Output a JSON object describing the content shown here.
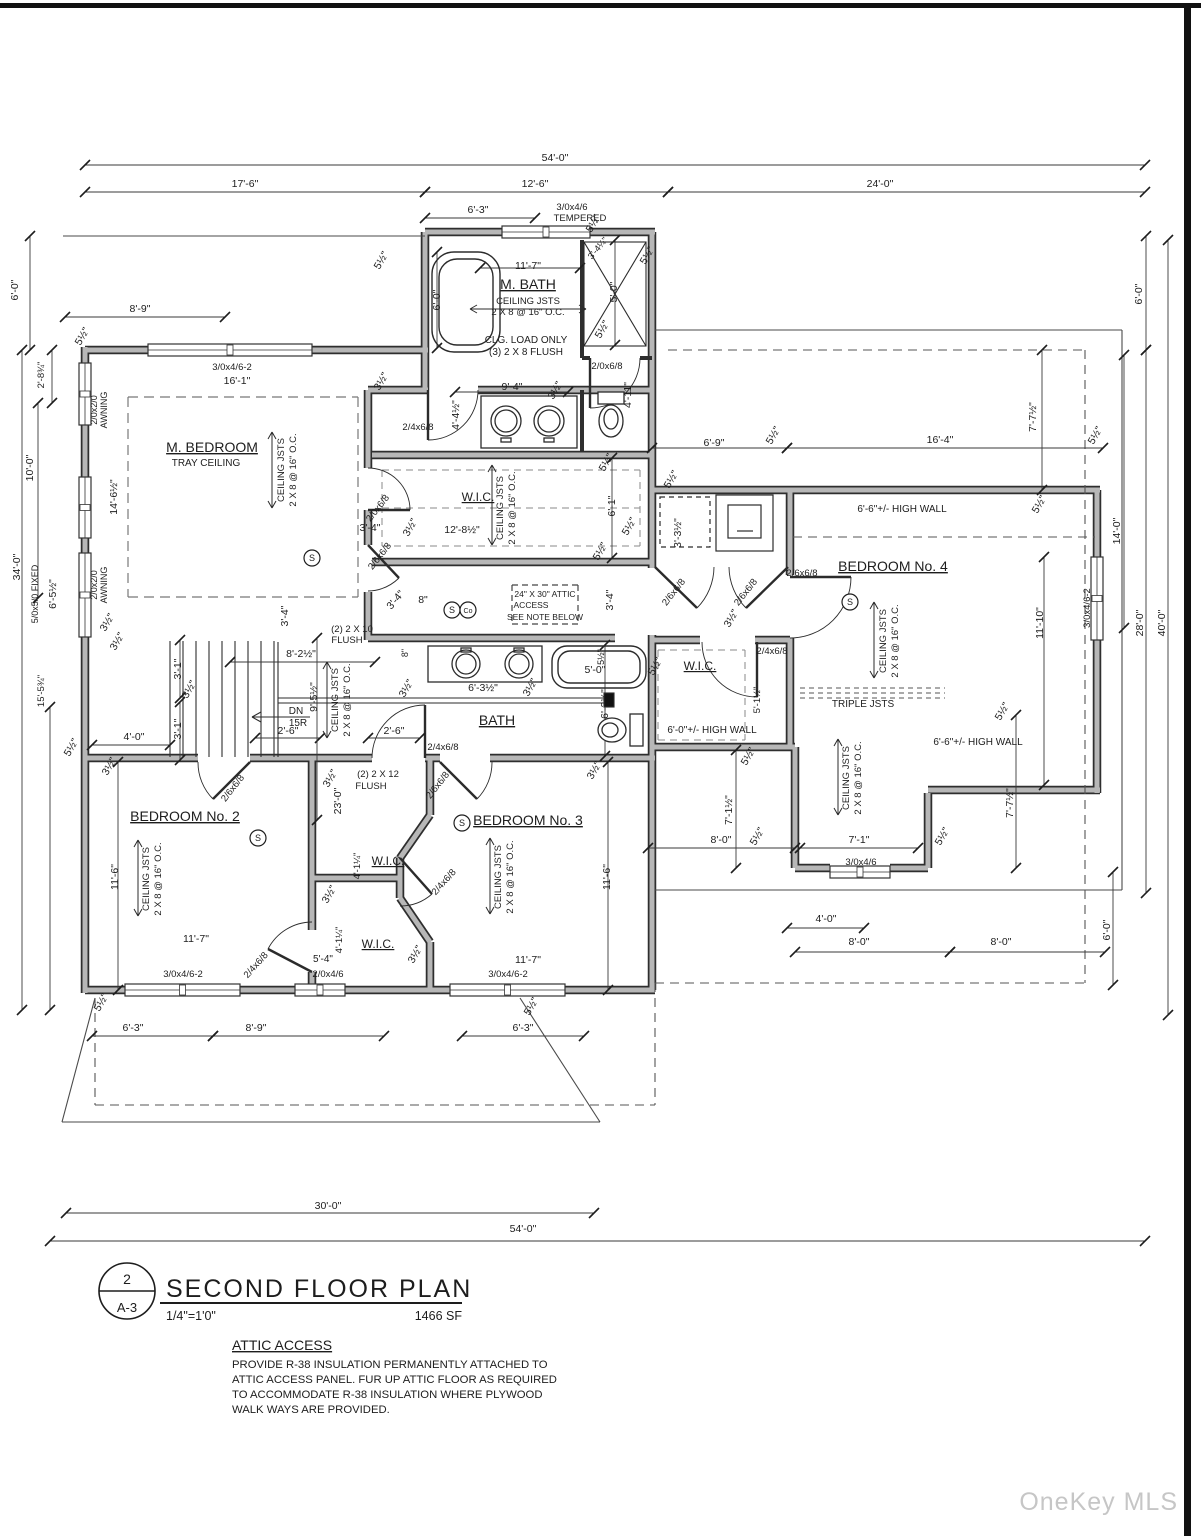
{
  "title_block": {
    "number": "2",
    "sheet": "A-3",
    "title": "SECOND FLOOR PLAN",
    "scale": "1/4\"=1'0\"",
    "area": "1466 SF"
  },
  "note": {
    "title": "ATTIC ACCESS",
    "l1": "PROVIDE R-38 INSULATION PERMANENTLY ATTACHED TO",
    "l2": "ATTIC ACCESS PANEL. FUR UP ATTIC FLOOR AS REQUIRED",
    "l3": "TO ACCOMMODATE R-38 INSULATION WHERE PLYWOOD",
    "l4": "WALK WAYS ARE PROVIDED."
  },
  "watermark": "OneKey MLS",
  "rooms": [
    "M. BEDROOM",
    "M. BATH",
    "W.I.C.",
    "BATH",
    "BEDROOM No. 2",
    "BEDROOM No. 3",
    "BEDROOM No. 4"
  ],
  "detectors": [
    {
      "x": 312,
      "y": 558,
      "t": "S"
    },
    {
      "x": 452,
      "y": 610,
      "t": "S"
    },
    {
      "x": 468,
      "y": 610,
      "t": "Co"
    },
    {
      "x": 258,
      "y": 838,
      "t": "S"
    },
    {
      "x": 462,
      "y": 823,
      "t": "S"
    },
    {
      "x": 850,
      "y": 602,
      "t": "S"
    }
  ],
  "labels": [
    {
      "t": "54'-0\"",
      "x": 555,
      "y": 161
    },
    {
      "t": "17'-6\"",
      "x": 245,
      "y": 187
    },
    {
      "t": "12'-6\"",
      "x": 535,
      "y": 187
    },
    {
      "t": "24'-0\"",
      "x": 880,
      "y": 187
    },
    {
      "t": "6'-3\"",
      "x": 478,
      "y": 213
    },
    {
      "t": "3/0x4/6",
      "x": 572,
      "y": 210,
      "fs": 9.5
    },
    {
      "t": "TEMPERED",
      "x": 580,
      "y": 221,
      "fs": 9.5
    },
    {
      "t": "5½\"",
      "x": 384,
      "y": 262,
      "r": -60
    },
    {
      "t": "5½\"",
      "x": 596,
      "y": 225,
      "r": -60
    },
    {
      "t": "3'-4¼\"",
      "x": 600,
      "y": 250,
      "r": -50,
      "fs": 9
    },
    {
      "t": "5'-0\"",
      "x": 617,
      "y": 292,
      "r": -90
    },
    {
      "t": "5½\"",
      "x": 605,
      "y": 331,
      "r": -60
    },
    {
      "t": "5½\"",
      "x": 650,
      "y": 257,
      "r": -60
    },
    {
      "t": "11'-7\"",
      "x": 528,
      "y": 269
    },
    {
      "t": "M. BATH",
      "x": 528,
      "y": 289,
      "fs": 14,
      "u": 1
    },
    {
      "t": "CEILING JSTS",
      "x": 528,
      "y": 304,
      "fs": 9.5
    },
    {
      "t": "2 X 8 @ 16\" O.C.",
      "x": 528,
      "y": 315,
      "fs": 9.5
    },
    {
      "t": "CLG. LOAD ONLY",
      "x": 526,
      "y": 343,
      "fs": 10
    },
    {
      "t": "(3) 2 X 8 FLUSH",
      "x": 526,
      "y": 355,
      "fs": 10
    },
    {
      "t": "6'-0\"",
      "x": 440,
      "y": 300,
      "r": -90
    },
    {
      "t": "2/0x6/8",
      "x": 607,
      "y": 369,
      "fs": 9.5
    },
    {
      "t": "9'-4\"",
      "x": 512,
      "y": 390
    },
    {
      "t": "3½\"",
      "x": 558,
      "y": 392,
      "r": -60
    },
    {
      "t": "4'-4½\"",
      "x": 459,
      "y": 415,
      "r": -90
    },
    {
      "t": "2/4x6/8",
      "x": 418,
      "y": 430,
      "fs": 9.5
    },
    {
      "t": "4'-11\"",
      "x": 631,
      "y": 395,
      "r": -90
    },
    {
      "t": "16'-1\"",
      "x": 237,
      "y": 384
    },
    {
      "t": "3½\"",
      "x": 384,
      "y": 383,
      "r": -60
    },
    {
      "t": "M. BEDROOM",
      "x": 212,
      "y": 452,
      "fs": 14,
      "u": 1
    },
    {
      "t": "TRAY CEILING",
      "x": 206,
      "y": 466,
      "fs": 10
    },
    {
      "t": "CEILING JSTS",
      "x": 284,
      "y": 470,
      "r": -90,
      "fs": 9.5
    },
    {
      "t": "2 X 8 @ 16\" O.C.",
      "x": 296,
      "y": 470,
      "r": -90,
      "fs": 9.5
    },
    {
      "t": "14'-6½\"",
      "x": 117,
      "y": 497,
      "r": -90
    },
    {
      "t": "2/0x2/0",
      "x": 97,
      "y": 410,
      "r": -90,
      "fs": 9
    },
    {
      "t": "AWNING",
      "x": 107,
      "y": 410,
      "r": -90,
      "fs": 9
    },
    {
      "t": "2/0x2/0",
      "x": 97,
      "y": 585,
      "r": -90,
      "fs": 9
    },
    {
      "t": "AWNING",
      "x": 107,
      "y": 585,
      "r": -90,
      "fs": 9
    },
    {
      "t": "5/0x5/0 FIXED",
      "x": 38,
      "y": 594,
      "r": -90,
      "fs": 9
    },
    {
      "t": "6'-5½\"",
      "x": 56,
      "y": 594,
      "r": -90
    },
    {
      "t": "5½\"",
      "x": 85,
      "y": 338,
      "r": -60
    },
    {
      "t": "3½\"",
      "x": 110,
      "y": 624,
      "r": -60
    },
    {
      "t": "2/0x6/8",
      "x": 380,
      "y": 510,
      "r": -52,
      "fs": 9.5
    },
    {
      "t": "2/6x6/8",
      "x": 382,
      "y": 558,
      "r": -52,
      "fs": 9.5
    },
    {
      "t": "3'-4\"",
      "x": 288,
      "y": 616,
      "r": -90
    },
    {
      "t": "3'-4\"",
      "x": 370,
      "y": 531
    },
    {
      "t": "3½\"",
      "x": 413,
      "y": 529,
      "r": -60
    },
    {
      "t": "3'-4\"",
      "x": 398,
      "y": 602,
      "r": -50
    },
    {
      "t": "8\"",
      "x": 423,
      "y": 603
    },
    {
      "t": "(2) 2 X 10",
      "x": 352,
      "y": 632,
      "fs": 9.5
    },
    {
      "t": "FLUSH",
      "x": 347,
      "y": 643,
      "fs": 9.5
    },
    {
      "t": "8\"",
      "x": 408,
      "y": 653,
      "r": -90,
      "fs": 9
    },
    {
      "t": "3'-4\"",
      "x": 613,
      "y": 600,
      "r": -90
    },
    {
      "t": "24\" X 30\" ATTIC",
      "x": 545,
      "y": 597,
      "fs": 8.5
    },
    {
      "t": "ACCESS",
      "x": 531,
      "y": 608,
      "fs": 8.5
    },
    {
      "t": "SEE NOTE BELOW",
      "x": 545,
      "y": 620,
      "fs": 8.5
    },
    {
      "t": "8'-2½\"",
      "x": 301,
      "y": 657
    },
    {
      "t": "9'-5½\"",
      "x": 317,
      "y": 697,
      "r": -90
    },
    {
      "t": "CEILING JSTS",
      "x": 338,
      "y": 700,
      "r": -90,
      "fs": 9.5
    },
    {
      "t": "2 X 8 @ 16\" O.C.",
      "x": 350,
      "y": 700,
      "r": -90,
      "fs": 9.5
    },
    {
      "t": "DN",
      "x": 296,
      "y": 714,
      "fs": 10
    },
    {
      "t": "15R",
      "x": 298,
      "y": 726,
      "fs": 10
    },
    {
      "t": "3'-1\"",
      "x": 181,
      "y": 669,
      "r": -90
    },
    {
      "t": "3'-1\"",
      "x": 181,
      "y": 729,
      "r": -90
    },
    {
      "t": "3½\"",
      "x": 192,
      "y": 691,
      "r": -60
    },
    {
      "t": "4'-0\"",
      "x": 134,
      "y": 740
    },
    {
      "t": "3½\"",
      "x": 120,
      "y": 643,
      "r": -60
    },
    {
      "t": "2'-6\"",
      "x": 288,
      "y": 734
    },
    {
      "t": "2'-6\"",
      "x": 394,
      "y": 734
    },
    {
      "t": "(2) 2 X 12",
      "x": 378,
      "y": 777,
      "fs": 9.5
    },
    {
      "t": "FLUSH",
      "x": 371,
      "y": 789,
      "fs": 9.5
    },
    {
      "t": "23'-0\"",
      "x": 341,
      "y": 801,
      "r": -90
    },
    {
      "t": "3½\"",
      "x": 333,
      "y": 780,
      "r": -60
    },
    {
      "t": "3½\"",
      "x": 409,
      "y": 690,
      "r": -60
    },
    {
      "t": "2/4x6/8",
      "x": 443,
      "y": 750,
      "fs": 9.5
    },
    {
      "t": "2/6x6/8",
      "x": 440,
      "y": 787,
      "r": -52,
      "fs": 9.5
    },
    {
      "t": "2/6x6/8",
      "x": 235,
      "y": 790,
      "r": -52,
      "fs": 9.5
    },
    {
      "t": "BATH",
      "x": 497,
      "y": 725,
      "fs": 14,
      "u": 1
    },
    {
      "t": "6'-3½\"",
      "x": 483,
      "y": 691
    },
    {
      "t": "3½\"",
      "x": 533,
      "y": 689,
      "r": -60
    },
    {
      "t": "5'-0\"",
      "x": 595,
      "y": 673
    },
    {
      "t": "5½\"",
      "x": 604,
      "y": 657,
      "r": -90,
      "fs": 9
    },
    {
      "t": "6'-3½\"",
      "x": 608,
      "y": 704,
      "r": -90
    },
    {
      "t": "5½\"",
      "x": 658,
      "y": 668,
      "r": -60
    },
    {
      "t": "3½\"",
      "x": 597,
      "y": 772,
      "r": -60
    },
    {
      "t": "11'-6\"",
      "x": 610,
      "y": 877,
      "r": -90
    },
    {
      "t": "BEDROOM No. 2",
      "x": 185,
      "y": 821,
      "fs": 14,
      "u": 1
    },
    {
      "t": "CEILING JSTS",
      "x": 149,
      "y": 879,
      "r": -90,
      "fs": 9.5
    },
    {
      "t": "2 X 8 @ 16\" O.C.",
      "x": 161,
      "y": 879,
      "r": -90,
      "fs": 9.5
    },
    {
      "t": "11'-6\"",
      "x": 118,
      "y": 877,
      "r": -90
    },
    {
      "t": "BEDROOM No. 3",
      "x": 528,
      "y": 825,
      "fs": 14,
      "u": 1
    },
    {
      "t": "CEILING JSTS",
      "x": 501,
      "y": 877,
      "r": -90,
      "fs": 9.5
    },
    {
      "t": "2 X 8 @ 16\" O.C.",
      "x": 513,
      "y": 877,
      "r": -90,
      "fs": 9.5
    },
    {
      "t": "W.I.C.",
      "x": 388,
      "y": 865,
      "fs": 12,
      "u": 1
    },
    {
      "t": "W.I.C.",
      "x": 378,
      "y": 948,
      "fs": 12,
      "u": 1
    },
    {
      "t": "4'-1¼\"",
      "x": 360,
      "y": 866,
      "r": -90,
      "fs": 9.5
    },
    {
      "t": "3½\"",
      "x": 332,
      "y": 896,
      "r": -60
    },
    {
      "t": "2/4x6/8",
      "x": 446,
      "y": 884,
      "r": -48,
      "fs": 9.5
    },
    {
      "t": "4'-1¼\"",
      "x": 342,
      "y": 940,
      "r": -90,
      "fs": 9.5
    },
    {
      "t": "5'-4\"",
      "x": 323,
      "y": 962,
      "fs": 10
    },
    {
      "t": "2/0x4/6",
      "x": 328,
      "y": 977,
      "fs": 9.5
    },
    {
      "t": "3½\"",
      "x": 418,
      "y": 956,
      "r": -60
    },
    {
      "t": "11'-7\"",
      "x": 196,
      "y": 942
    },
    {
      "t": "3/0x4/6-2",
      "x": 183,
      "y": 977,
      "fs": 9.5
    },
    {
      "t": "11'-7\"",
      "x": 528,
      "y": 963
    },
    {
      "t": "3/0x4/6-2",
      "x": 508,
      "y": 977,
      "fs": 9.5
    },
    {
      "t": "2/4x6/8",
      "x": 258,
      "y": 967,
      "r": -48,
      "fs": 9.5
    },
    {
      "t": "3/0x4/6-2",
      "x": 232,
      "y": 370,
      "fs": 9.5
    },
    {
      "t": "8'-9\"",
      "x": 140,
      "y": 312
    },
    {
      "t": "5½\"",
      "x": 104,
      "y": 1004,
      "r": -60
    },
    {
      "t": "5½\"",
      "x": 534,
      "y": 1008,
      "r": -60
    },
    {
      "t": "6'-3\"",
      "x": 133,
      "y": 1031
    },
    {
      "t": "8'-9\"",
      "x": 256,
      "y": 1031
    },
    {
      "t": "6'-3\"",
      "x": 523,
      "y": 1031
    },
    {
      "t": "30'-0\"",
      "x": 328,
      "y": 1209
    },
    {
      "t": "54'-0\"",
      "x": 523,
      "y": 1232
    },
    {
      "t": "3½\"",
      "x": 112,
      "y": 768,
      "r": -60
    },
    {
      "t": "6'-9\"",
      "x": 714,
      "y": 446
    },
    {
      "t": "16'-4\"",
      "x": 940,
      "y": 443
    },
    {
      "t": "5½\"",
      "x": 776,
      "y": 437,
      "r": -60
    },
    {
      "t": "5½\"",
      "x": 1098,
      "y": 437,
      "r": -60
    },
    {
      "t": "7'-7½\"",
      "x": 1036,
      "y": 417,
      "r": -90
    },
    {
      "t": "5½\"",
      "x": 674,
      "y": 481,
      "r": -60
    },
    {
      "t": "5½\"",
      "x": 632,
      "y": 528,
      "r": -60
    },
    {
      "t": "3'-3½\"",
      "x": 681,
      "y": 533,
      "r": -90
    },
    {
      "t": "2/6x6/8",
      "x": 676,
      "y": 594,
      "r": -52,
      "fs": 9.5
    },
    {
      "t": "2/6x6/8",
      "x": 748,
      "y": 594,
      "r": -52,
      "fs": 9.5
    },
    {
      "t": "2/6x6/8",
      "x": 802,
      "y": 576,
      "fs": 9.5
    },
    {
      "t": "2/4x6/8",
      "x": 772,
      "y": 654,
      "fs": 9.5
    },
    {
      "t": "3½\"",
      "x": 734,
      "y": 620,
      "r": -60
    },
    {
      "t": "BEDROOM No. 4",
      "x": 893,
      "y": 571,
      "fs": 14,
      "u": 1
    },
    {
      "t": "6'-6\"+/- HIGH WALL",
      "x": 902,
      "y": 512,
      "fs": 10
    },
    {
      "t": "CEILING JSTS",
      "x": 886,
      "y": 641,
      "r": -90,
      "fs": 9.5
    },
    {
      "t": "2 X 8 @ 16\" O.C.",
      "x": 898,
      "y": 641,
      "r": -90,
      "fs": 9.5
    },
    {
      "t": "3/0x4/6-2",
      "x": 1090,
      "y": 608,
      "r": -90,
      "fs": 9.5
    },
    {
      "t": "11'-10\"",
      "x": 1043,
      "y": 623,
      "r": -90
    },
    {
      "t": "14'-0\"",
      "x": 1120,
      "y": 531,
      "r": -90
    },
    {
      "t": "28'-0\"",
      "x": 1143,
      "y": 623,
      "r": -90
    },
    {
      "t": "40'-0\"",
      "x": 1165,
      "y": 623,
      "r": -90
    },
    {
      "t": "6'-0\"",
      "x": 1142,
      "y": 294,
      "r": -90
    },
    {
      "t": "6'-0\"",
      "x": 18,
      "y": 290,
      "r": -90
    },
    {
      "t": "2'-8¾\"",
      "x": 44,
      "y": 375,
      "r": -90,
      "fs": 9.5
    },
    {
      "t": "10'-0\"",
      "x": 33,
      "y": 468,
      "r": -90
    },
    {
      "t": "34'-0\"",
      "x": 20,
      "y": 567,
      "r": -90
    },
    {
      "t": "15'-5¾\"",
      "x": 44,
      "y": 691,
      "r": -90,
      "fs": 9.5
    },
    {
      "t": "5½\"",
      "x": 74,
      "y": 749,
      "r": -60
    },
    {
      "t": "5½\"",
      "x": 1042,
      "y": 506,
      "r": -60
    },
    {
      "t": "W.I.C.",
      "x": 700,
      "y": 670,
      "fs": 12,
      "u": 1
    },
    {
      "t": "5'-1½\"",
      "x": 760,
      "y": 700,
      "r": -90,
      "fs": 9.5
    },
    {
      "t": "6'-0\"+/- HIGH WALL",
      "x": 712,
      "y": 733,
      "fs": 10
    },
    {
      "t": "5½\"",
      "x": 751,
      "y": 758,
      "r": -60
    },
    {
      "t": "TRIPLE JSTS",
      "x": 863,
      "y": 707,
      "fs": 10
    },
    {
      "t": "CEILING JSTS",
      "x": 849,
      "y": 778,
      "r": -90,
      "fs": 9.5
    },
    {
      "t": "2 X 8 @ 16\" O.C.",
      "x": 861,
      "y": 778,
      "r": -90,
      "fs": 9.5
    },
    {
      "t": "7'-1½\"",
      "x": 732,
      "y": 810,
      "r": -90
    },
    {
      "t": "7'-7½\"",
      "x": 1013,
      "y": 803,
      "r": -90
    },
    {
      "t": "6'-6\"+/- HIGH WALL",
      "x": 978,
      "y": 745,
      "fs": 10
    },
    {
      "t": "5½\"",
      "x": 1005,
      "y": 713,
      "r": -60
    },
    {
      "t": "8'-0\"",
      "x": 721,
      "y": 843
    },
    {
      "t": "5½\"",
      "x": 760,
      "y": 838,
      "r": -60
    },
    {
      "t": "7'-1\"",
      "x": 859,
      "y": 843
    },
    {
      "t": "5½\"",
      "x": 945,
      "y": 838,
      "r": -60
    },
    {
      "t": "3/0x4/6",
      "x": 861,
      "y": 865,
      "fs": 9.5
    },
    {
      "t": "4'-0\"",
      "x": 826,
      "y": 922
    },
    {
      "t": "8'-0\"",
      "x": 859,
      "y": 945
    },
    {
      "t": "8'-0\"",
      "x": 1001,
      "y": 945
    },
    {
      "t": "6'-0\"",
      "x": 1110,
      "y": 930,
      "r": -90
    },
    {
      "t": "W.I.C.",
      "x": 478,
      "y": 501,
      "fs": 12,
      "u": 1
    },
    {
      "t": "CEILING JSTS",
      "x": 503,
      "y": 508,
      "r": -90,
      "fs": 9.5
    },
    {
      "t": "2 X 8 @ 16\" O.C.",
      "x": 515,
      "y": 508,
      "r": -90,
      "fs": 9.5
    },
    {
      "t": "12'-8½\"",
      "x": 462,
      "y": 533
    },
    {
      "t": "6'-1\"",
      "x": 615,
      "y": 506,
      "r": -90
    },
    {
      "t": "5½\"",
      "x": 609,
      "y": 464,
      "r": -60
    },
    {
      "t": "5½\"",
      "x": 603,
      "y": 553,
      "r": -60
    }
  ]
}
